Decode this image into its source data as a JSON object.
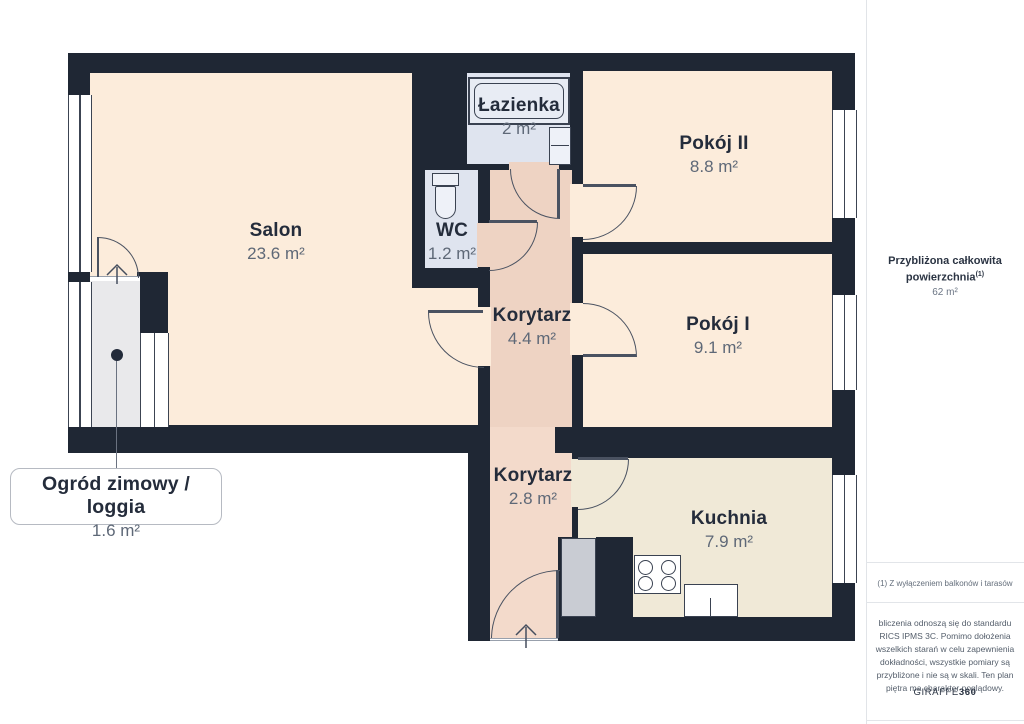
{
  "plan": {
    "rooms": [
      {
        "id": "salon",
        "name": "Salon",
        "area": "23.6 m²"
      },
      {
        "id": "lazienka",
        "name": "Łazienka",
        "area": "2 m²"
      },
      {
        "id": "wc",
        "name": "WC",
        "area": "1.2 m²"
      },
      {
        "id": "pokoj2",
        "name": "Pokój II",
        "area": "8.8 m²"
      },
      {
        "id": "pokoj1",
        "name": "Pokój I",
        "area": "9.1 m²"
      },
      {
        "id": "korytarz1",
        "name": "Korytarz",
        "area": "4.4 m²"
      },
      {
        "id": "korytarz2",
        "name": "Korytarz",
        "area": "2.8 m²"
      },
      {
        "id": "kuchnia",
        "name": "Kuchnia",
        "area": "7.9 m²"
      }
    ],
    "callout": {
      "name": "Ogród zimowy / loggia",
      "area": "1.6 m²"
    }
  },
  "sidebar": {
    "total_label": "Przybliżona całkowita powierzchnia",
    "total_sup": "(1)",
    "total_value": "62 m²",
    "footnote": "(1) Z wyłączeniem balkonów i tarasów",
    "disclaimer": "bliczenia odnoszą się do standardu RICS IPMS 3C. Pomimo dołożenia wszelkich starań w celu zapewnienia dokładności, wszystkie pomiary są przybliżone i nie są w skali. Ten plan piętra ma charakter poglądowy.",
    "brand_name": "GIRAFFE",
    "brand_number": "360"
  },
  "colors": {
    "wall": "#1f2734",
    "room_floor": "#fcecdb",
    "corridor_floor": "#eed3c3",
    "bathroom_floor": "#dfe4ef",
    "kitchen_floor": "#f0e9d7",
    "loggia_floor": "#e9e9eb"
  }
}
